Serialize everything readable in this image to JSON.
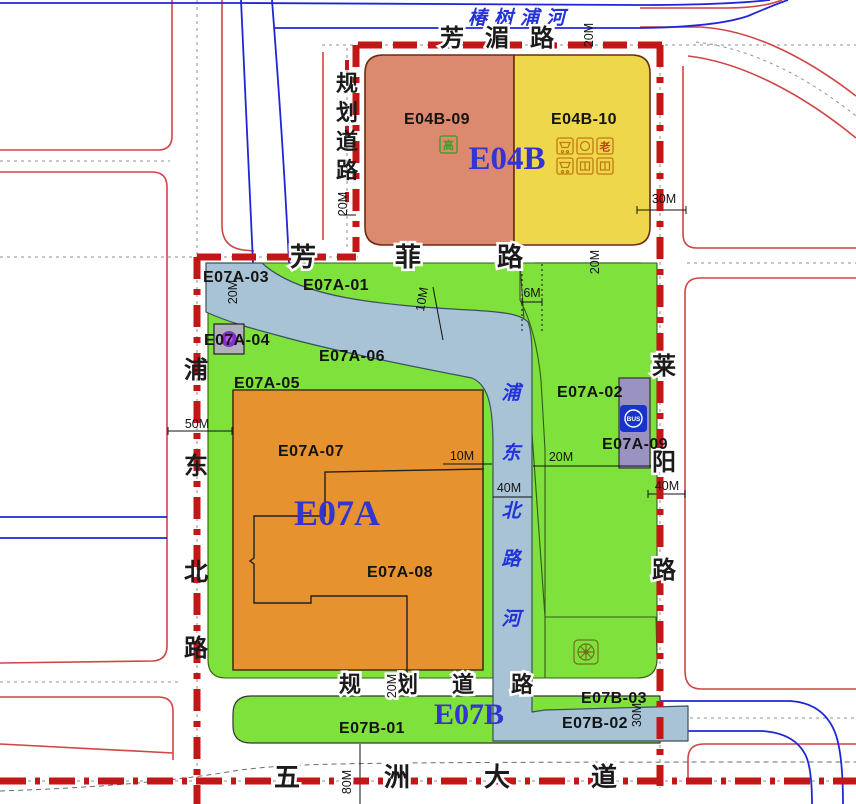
{
  "zones": {
    "e04b": {
      "title": "E04B",
      "parcels": [
        "E04B-09",
        "E04B-10"
      ]
    },
    "e07a": {
      "title": "E07A",
      "parcels": [
        "E07A-01",
        "E07A-02",
        "E07A-03",
        "E07A-04",
        "E07A-05",
        "E07A-06",
        "E07A-07",
        "E07A-08",
        "E07A-09"
      ]
    },
    "e07b": {
      "title": "E07B",
      "parcels": [
        "E07B-01",
        "E07B-02",
        "E07B-03"
      ]
    }
  },
  "rivers": {
    "chunshupu": "椿树浦河",
    "pudongbei_he": [
      "浦",
      "东",
      "北",
      "路",
      "河"
    ]
  },
  "roads": {
    "fangmei": [
      "芳",
      "湄",
      "路"
    ],
    "fangfei": [
      "芳",
      "菲",
      "路"
    ],
    "guihua_west": [
      "规",
      "划",
      "道",
      "路"
    ],
    "guihua_south": [
      "规",
      "划",
      "道",
      "路"
    ],
    "pudongbei": [
      "浦",
      "东",
      "北",
      "路"
    ],
    "laiyang": [
      "莱",
      "阳",
      "路"
    ],
    "wuzhou": [
      "五",
      "洲",
      "大",
      "道"
    ]
  },
  "dimensions": {
    "d6": "6M",
    "d10": "10M",
    "d20": "20M",
    "d30": "30M",
    "d40": "40M",
    "d50": "50M",
    "d80": "80M"
  },
  "icons": {
    "bus": "BUS",
    "highrise": "高",
    "elderly": "老"
  },
  "colors": {
    "boundary_red": "#c31616",
    "road_edge_red": "#d04545",
    "water_blue": "#a9c3d6",
    "parcel_salmon": "#dc8a6f",
    "parcel_yellow": "#efd74b",
    "parcel_orange": "#e6922e",
    "parcel_green": "#7fe13b",
    "parcel_beige": "#dcd7a6",
    "parcel_purple": "#9a93c2",
    "river_line_blue": "#2026d8",
    "zone_label_blue": "#3434d2",
    "label_black": "#1b1b1b"
  }
}
